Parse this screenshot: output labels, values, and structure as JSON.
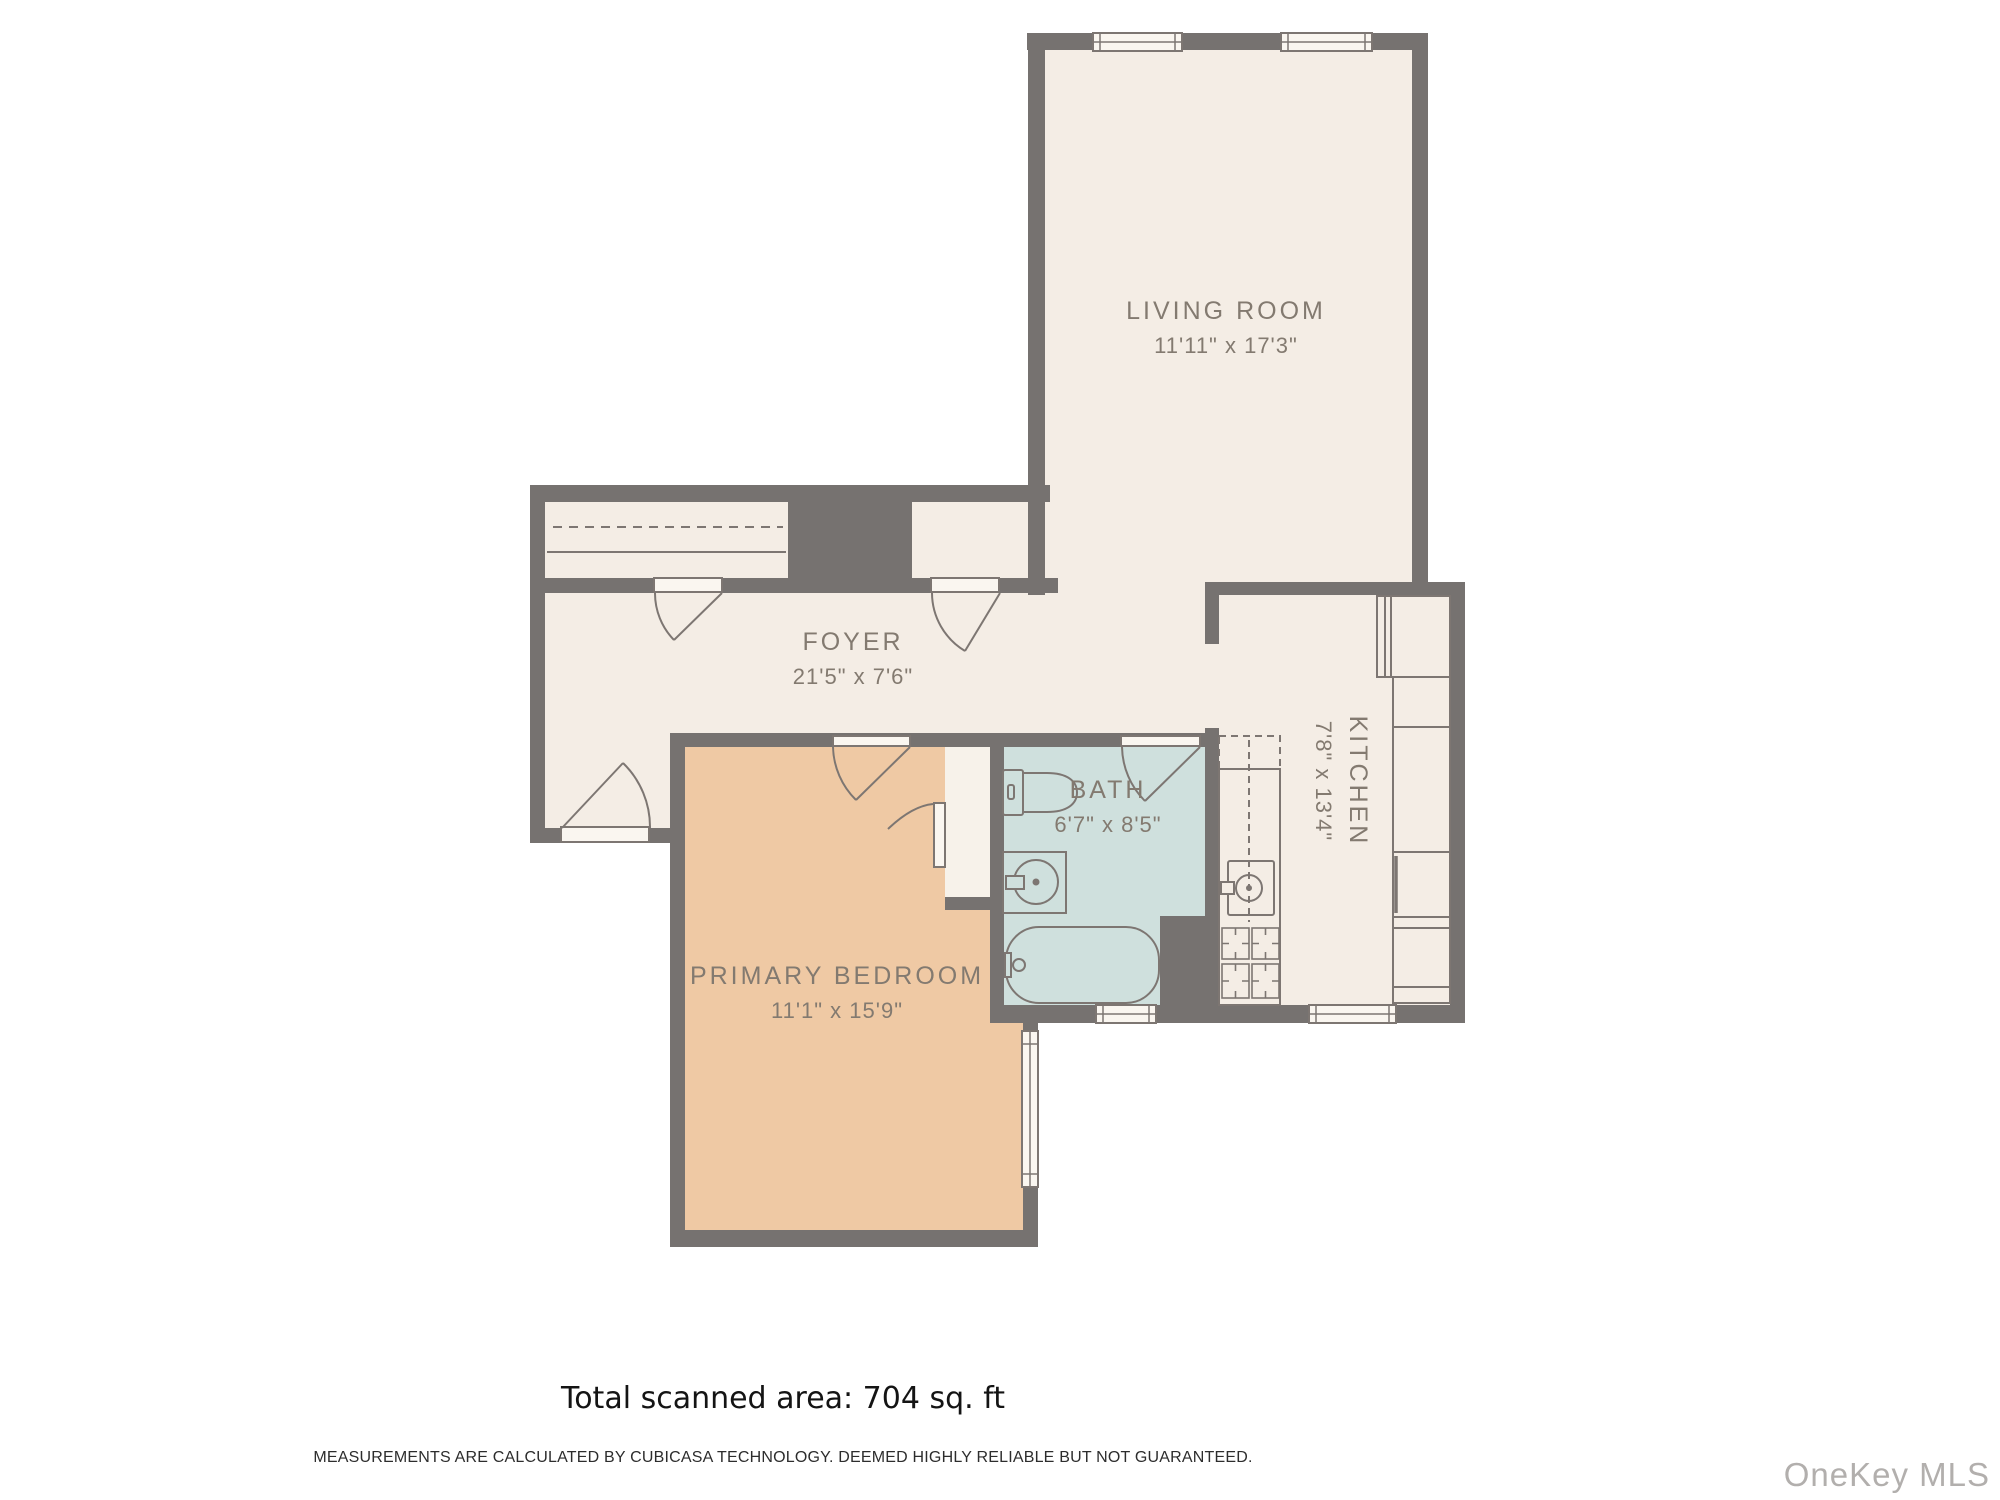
{
  "plan": {
    "wall_color": "#767270",
    "floor_color": "#f4ede5",
    "bedroom_floor_color": "#efc9a4",
    "bath_floor_color": "#cfe0dd",
    "label_color": "#837a70"
  },
  "rooms": [
    {
      "id": "living-room",
      "name": "LIVING ROOM",
      "dims": "11'11\" x 17'3\""
    },
    {
      "id": "foyer",
      "name": "FOYER",
      "dims": "21'5\" x 7'6\""
    },
    {
      "id": "kitchen",
      "name": "KITCHEN",
      "dims": "7'8\" x 13'4\""
    },
    {
      "id": "bath",
      "name": "BATH",
      "dims": "6'7\" x 8'5\""
    },
    {
      "id": "primary-bedroom",
      "name": "PRIMARY BEDROOM",
      "dims": "11'1\" x 15'9\""
    }
  ],
  "footer": {
    "total_area": "Total scanned area: 704 sq. ft",
    "disclaimer": "MEASUREMENTS ARE CALCULATED BY CUBICASA TECHNOLOGY. DEEMED HIGHLY RELIABLE BUT NOT GUARANTEED.",
    "watermark": "OneKey MLS"
  }
}
